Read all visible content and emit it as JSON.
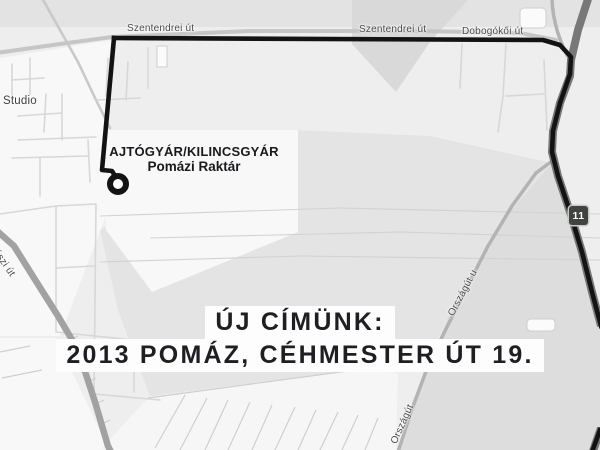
{
  "labels": {
    "szentendrei_1": "Szentendrei út",
    "szentendrei_2": "Szentendrei út",
    "dobogokoi": "Dobogókői út",
    "studio": "Studio",
    "orszagut_u": "Országút u",
    "orszagut": "Országút",
    "kalaszi": "kalászi út"
  },
  "shield": {
    "route_number": "11"
  },
  "destination": {
    "name": "AJTÓGYÁR/KILINCSGYÁR",
    "subtitle": "Pomázi Raktár"
  },
  "announcement": {
    "line1": "ÚJ CÍMÜNK:",
    "line2": "2013 POMÁZ, CÉHMESTER ÚT 19."
  },
  "icons": {
    "destination_marker": "circle-ring-marker",
    "route_line": "bold-route-path"
  },
  "colors": {
    "route": "#131313",
    "road_major": "#787878",
    "road_mid": "#b3b3b3",
    "background": "#eeeeee",
    "field": "#e3e4e3",
    "shield_bg": "#414341",
    "box_bg": "#fdfdfd",
    "title_text": "#1a1a1e"
  }
}
